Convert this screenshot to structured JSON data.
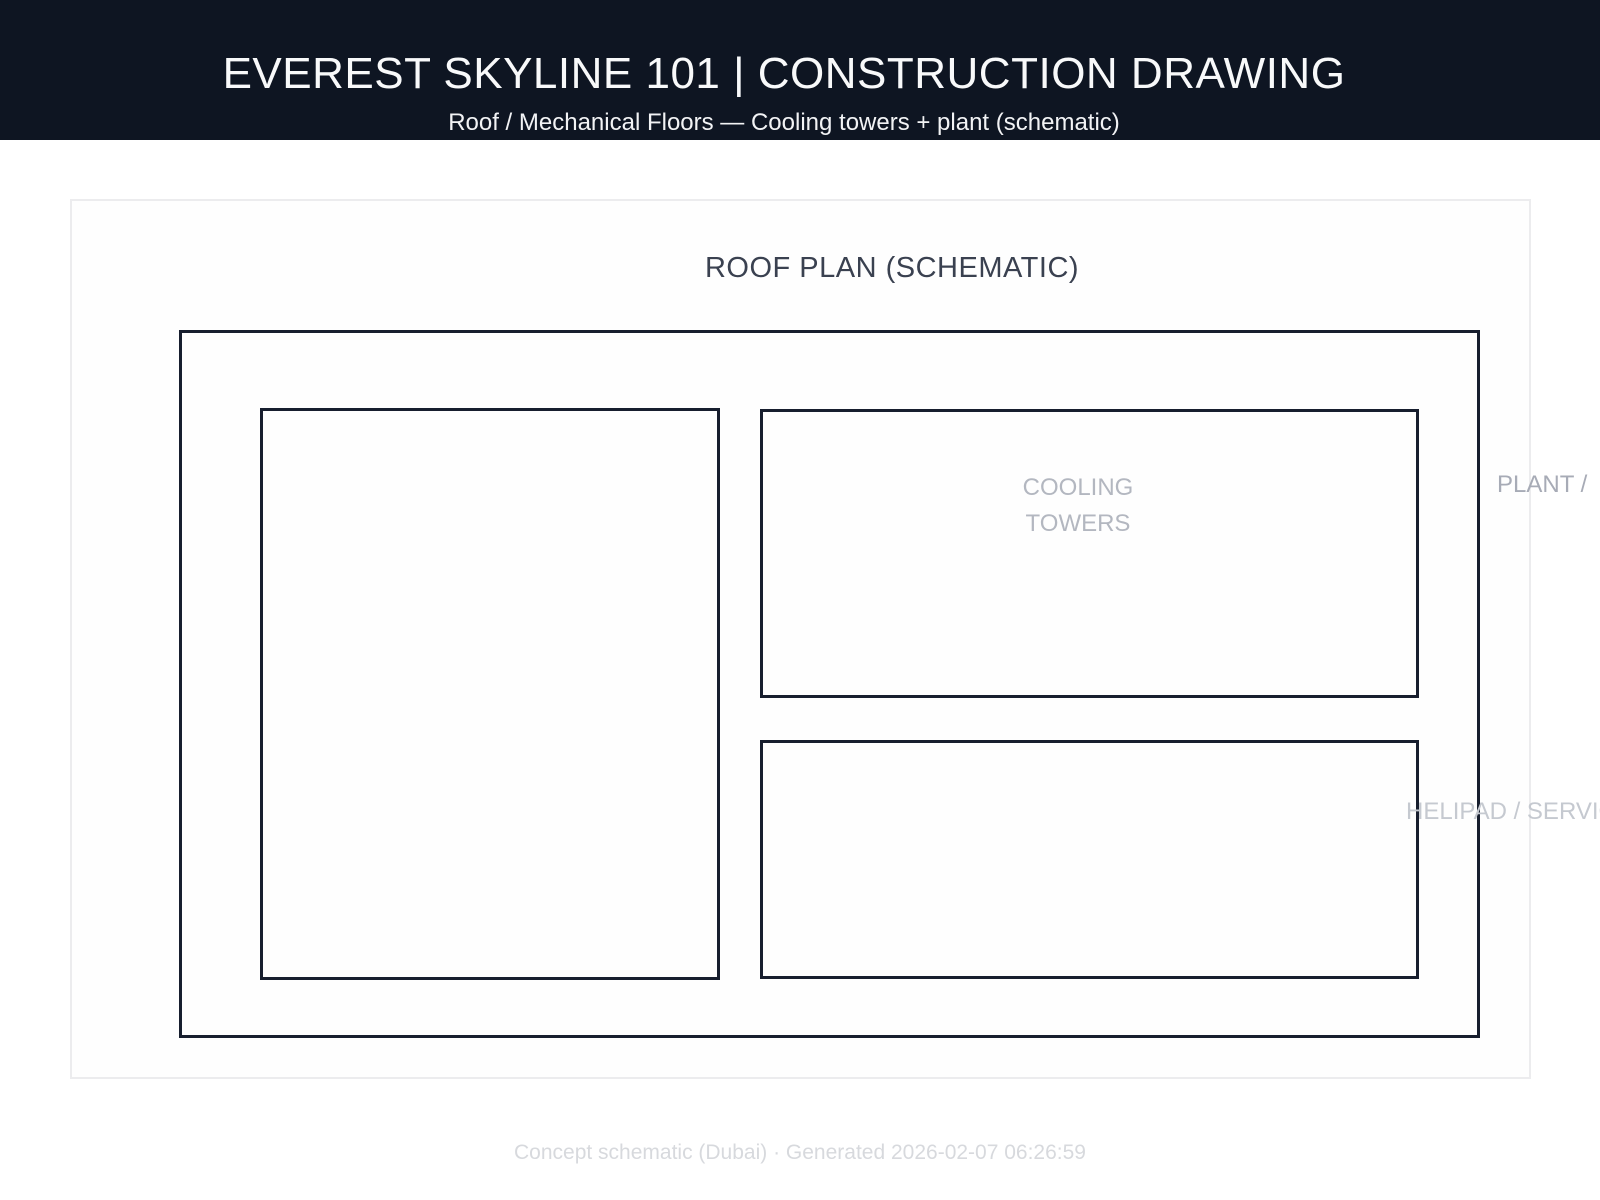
{
  "header": {
    "title": "EVEREST SKYLINE 101 | CONSTRUCTION DRAWING",
    "subtitle": "Roof / Mechanical Floors — Cooling towers + plant (schematic)"
  },
  "drawing": {
    "title": "ROOF PLAN (SCHEMATIC)",
    "labels": {
      "cooling": "COOLING\nTOWERS",
      "plant": "PLANT /",
      "helipad": "HELIPAD / SERVIC"
    }
  },
  "footer": {
    "caption": "Concept schematic (Dubai) · Generated 2026-02-07 06:26:59"
  },
  "colors": {
    "header_bg": "#0e1522",
    "header_text": "#f8f9fa",
    "drawing_line": "#171e2e",
    "panel_border": "#ececee",
    "plan_title_text": "#3a4150",
    "cooling_label_text": "#b3b7c0",
    "plant_label_text": "#a7abb6",
    "helipad_label_text": "#c5c9d0",
    "footer_text": "#d7d9dd"
  }
}
